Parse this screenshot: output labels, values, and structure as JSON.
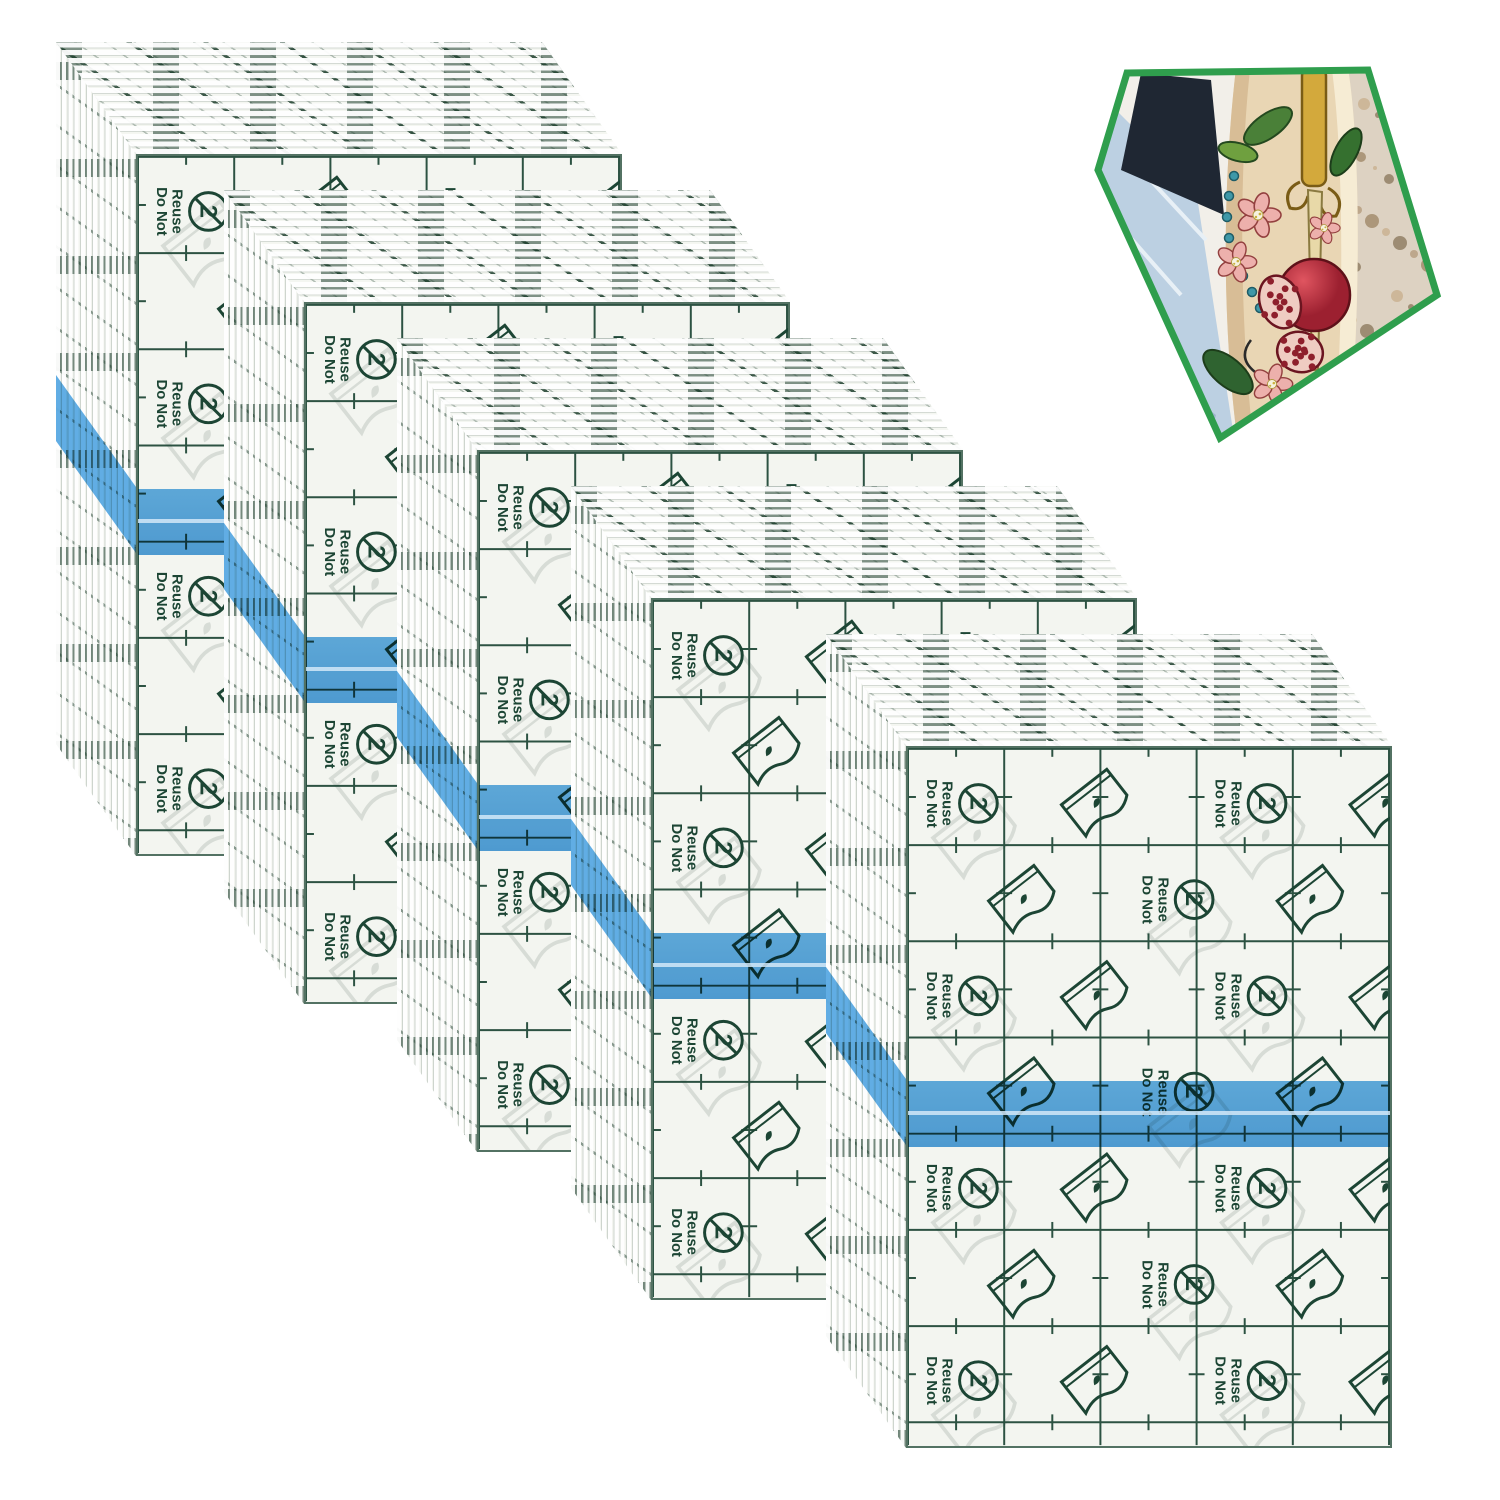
{
  "product_photo": {
    "description": "Stacks of transparent tattoo-aftercare adhesive film sheets with pentagon inset photo of a tattooed arm",
    "stack_count": 5,
    "labels": {
      "do_not": "Do Not",
      "reuse": "Reuse",
      "symbol_digit": "2"
    },
    "icons": [
      "do-not-reuse-symbol",
      "peel-film-icon"
    ],
    "colors": {
      "ink_green": "#1c4534",
      "ghost_gray": "#d3d8d2",
      "face_bg": "#f3f5f0",
      "stripe_blue": "#53a7e3",
      "stripe_blue_dark": "#4398da",
      "pentagon_border_green": "#2f9e4d",
      "skin": "#e9d6b4",
      "denim_blue": "#bcd0e2",
      "floor_tan": "#ddd2c2",
      "pomegranate_red": "#c33643",
      "leaf_green": "#3f7a35",
      "gold": "#d3a93c",
      "navy_shadow": "#1f2733"
    },
    "inset": {
      "shape": "pentagon",
      "subject": "tattooed-arm-photo"
    }
  }
}
